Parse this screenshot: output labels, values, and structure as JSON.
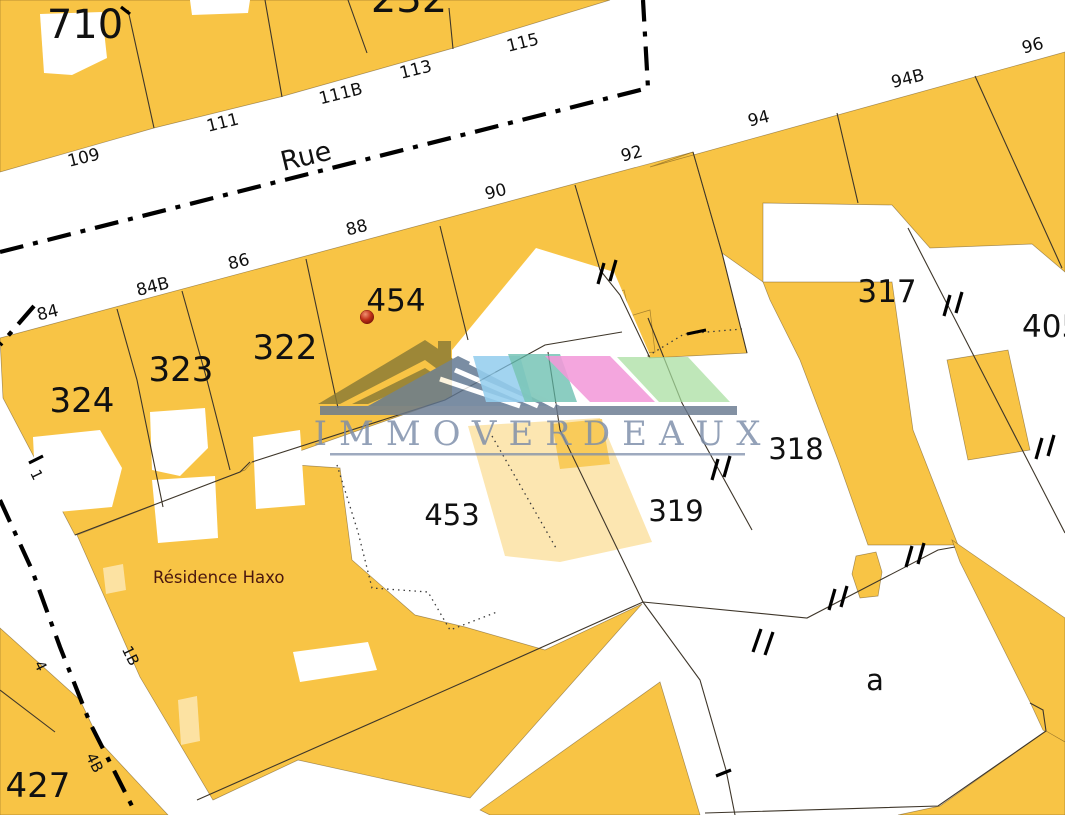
{
  "map": {
    "street_name": "Rue",
    "residence_name": "Résidence Haxo",
    "watermark": {
      "text": "IMMOVERDEAUX"
    },
    "parcels": {
      "p710": "710",
      "p232": "232",
      "p324": "324",
      "p323": "323",
      "p322": "322",
      "p454": "454",
      "p317": "317",
      "p405": "405",
      "p318": "318",
      "p319": "319",
      "p453": "453",
      "p427": "427",
      "pa": "a"
    },
    "house_numbers": {
      "h109": "109",
      "h111": "111",
      "h111b": "111B",
      "h113": "113",
      "h115": "115",
      "h84": "84",
      "h84b": "84B",
      "h86": "86",
      "h88": "88",
      "h90": "90",
      "h92": "92",
      "h94": "94",
      "h94b": "94B",
      "h96": "96"
    },
    "side_street_numbers": {
      "s1": "1",
      "s4": "4",
      "s1b": "1B",
      "s4b": "4B"
    },
    "marker": {
      "parcel": "454"
    },
    "colors": {
      "parcel_fill": "#F8C445",
      "boundary": "#3E362A",
      "street_centerline": "#000000",
      "label": "#111111",
      "residence_label": "#4A170F",
      "marker_red": "#C03018",
      "logo_slate": "#68798F",
      "logo_text": "#7C8DA9",
      "logo_khaki": "#8A7A35",
      "logo_blue": "#7EC4EA",
      "logo_teal": "#5FB9A9",
      "logo_pink": "#F083D2",
      "logo_green": "#A6DE9E"
    }
  }
}
